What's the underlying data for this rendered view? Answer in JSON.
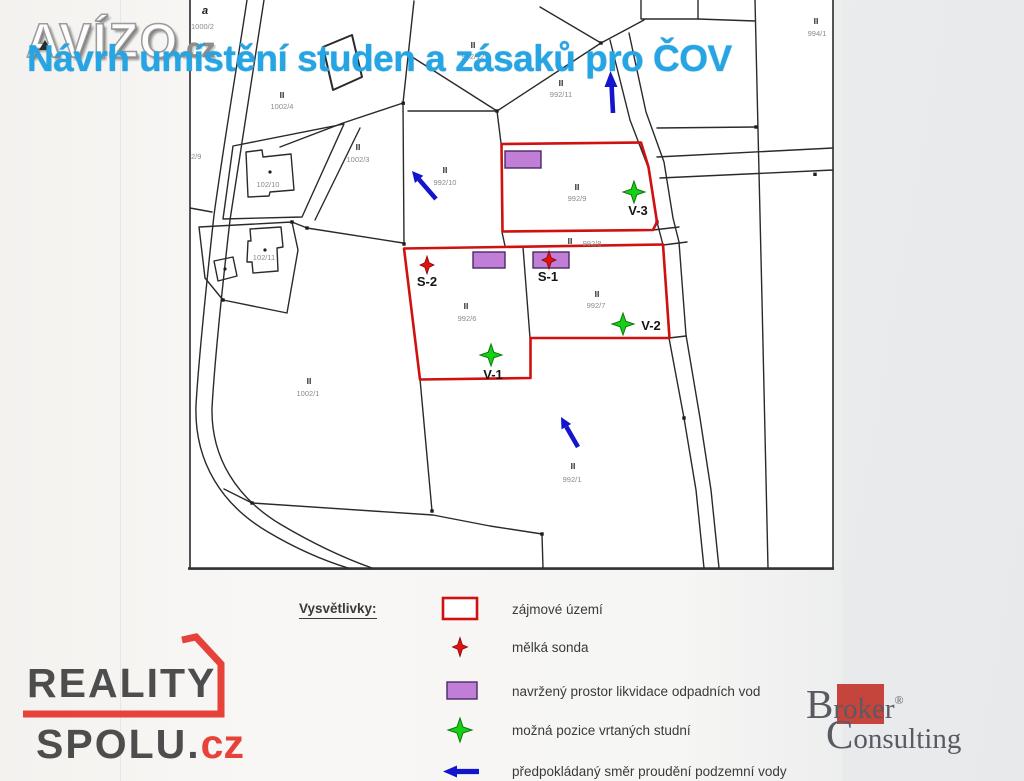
{
  "title": "Návrh umístění studen a zásaků pro ČOV",
  "watermarks": {
    "avizo": {
      "name": "AVÍZO",
      "tld": ".cz"
    },
    "reality": {
      "line1": "REALITY",
      "line2": "SPOLU.",
      "tld": "cz"
    },
    "broker": {
      "b_cap": "B",
      "b_rest": "roker",
      "reg": "®",
      "c_cap": "C",
      "c_rest": "onsulting"
    }
  },
  "map": {
    "symbol_a": "a",
    "parcels": [
      {
        "marker": "",
        "number": "1000/2"
      },
      {
        "marker": "II",
        "number": "1002/4"
      },
      {
        "marker": "II",
        "number": "1002/3"
      },
      {
        "marker": "II",
        "number": "992/12"
      },
      {
        "marker": "II",
        "number": "992/10"
      },
      {
        "marker": "II",
        "number": "992/11"
      },
      {
        "marker": "II",
        "number": "992/9"
      },
      {
        "marker": "II",
        "number": "992/8"
      },
      {
        "marker": "II",
        "number": "992/7"
      },
      {
        "marker": "II",
        "number": "992/6"
      },
      {
        "marker": "II",
        "number": "1002/1"
      },
      {
        "marker": "II",
        "number": "992/1"
      },
      {
        "marker": "II",
        "number": "994/1"
      },
      {
        "marker": "",
        "number": "102/10"
      },
      {
        "marker": "",
        "number": "102/11"
      },
      {
        "marker": "",
        "number": "2/9"
      }
    ],
    "markers": {
      "s1": "S-1",
      "s2": "S-2",
      "v1": "V-1",
      "v2": "V-2",
      "v3": "V-3"
    }
  },
  "legend": {
    "heading": "Vysvětlivky:",
    "items": [
      {
        "symbol": "red-outline-rect",
        "label": "zájmové území"
      },
      {
        "symbol": "red-probe-marker",
        "label": "mělká sonda"
      },
      {
        "symbol": "purple-rect",
        "label": "navržený prostor likvidace odpadních vod"
      },
      {
        "symbol": "green-well-marker",
        "label": "možná pozice vrtaných studní"
      },
      {
        "symbol": "blue-flow-arrow",
        "label": "předpokládaný směr proudění podzemní vody"
      }
    ]
  },
  "colors": {
    "title_blue": "#25a5e3",
    "map_red": "#cf1110",
    "purple_fill": "#c07ed6",
    "green": "#17cf17",
    "arrow_blue": "#1414cc",
    "logo_red": "#e6423a",
    "broker_red": "#c5443c"
  }
}
